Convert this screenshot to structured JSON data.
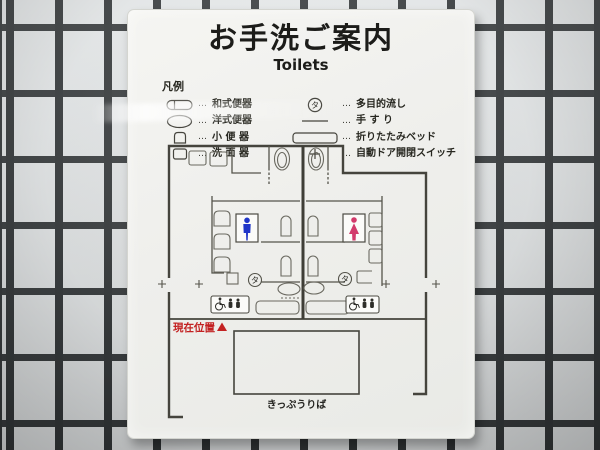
{
  "sign": {
    "title": "お手洗ご案内",
    "subtitle": "Toilets",
    "legend": {
      "heading": "凡例",
      "separator": "…",
      "left": [
        {
          "icon": "squat-toilet-symbol",
          "label": "和式便器"
        },
        {
          "icon": "western-toilet-symbol",
          "label": "洋式便器"
        },
        {
          "icon": "urinal-symbol",
          "label": "小 便 器"
        },
        {
          "icon": "washbasin-symbol",
          "label": "洗 面 器"
        }
      ],
      "right": [
        {
          "icon": "multipurpose-sink-symbol",
          "symbol_text": "タ",
          "label": "多目的流し"
        },
        {
          "icon": "handrail-symbol",
          "label": "手 す り"
        },
        {
          "icon": "folding-bed-symbol",
          "label": "折りたたみベッド"
        },
        {
          "icon": "auto-door-switch-symbol",
          "label": "自動ドア開閉スイッチ"
        }
      ]
    },
    "map": {
      "multi_sink_symbol": "タ",
      "current_location_label": "現在位置",
      "ticket_office_label": "きっぷうりば"
    },
    "colors": {
      "men_pictogram": "#2036c8",
      "women_pictogram": "#d23a6b",
      "current_location": "#c32222"
    }
  }
}
